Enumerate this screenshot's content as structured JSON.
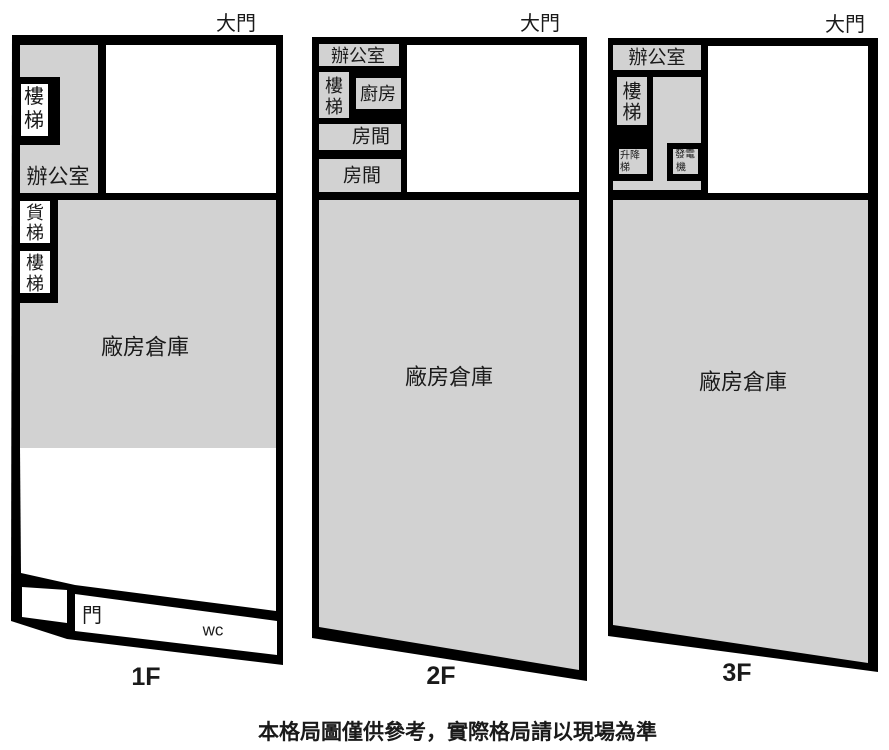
{
  "colors": {
    "wall": "#000000",
    "room_fill_gray": "#d2d2d2",
    "room_fill_white": "#ffffff",
    "text": "#1a1a1a"
  },
  "floor1": {
    "name": "1F",
    "gate_label": "大門",
    "office_label": "辦公室",
    "stairs_upper": [
      "樓",
      "梯"
    ],
    "freight_elevator": [
      "貨",
      "梯"
    ],
    "stairs_lower": [
      "樓",
      "梯"
    ],
    "warehouse_label": "廠房倉庫",
    "door_label": "門",
    "wc_label": "wc"
  },
  "floor2": {
    "name": "2F",
    "gate_label": "大門",
    "office_label": "辦公室",
    "stairs": [
      "樓",
      "梯"
    ],
    "kitchen_label": "廚房",
    "room1_label": "房間",
    "room2_label": "房間",
    "warehouse_label": "廠房倉庫"
  },
  "floor3": {
    "name": "3F",
    "gate_label": "大門",
    "office_label": "辦公室",
    "stairs": [
      "樓",
      "梯"
    ],
    "lift": [
      "升降",
      "梯"
    ],
    "generator": [
      "發電",
      "機"
    ],
    "warehouse_label": "廠房倉庫"
  },
  "disclaimer": "本格局圖僅供參考，實際格局請以現場為準"
}
